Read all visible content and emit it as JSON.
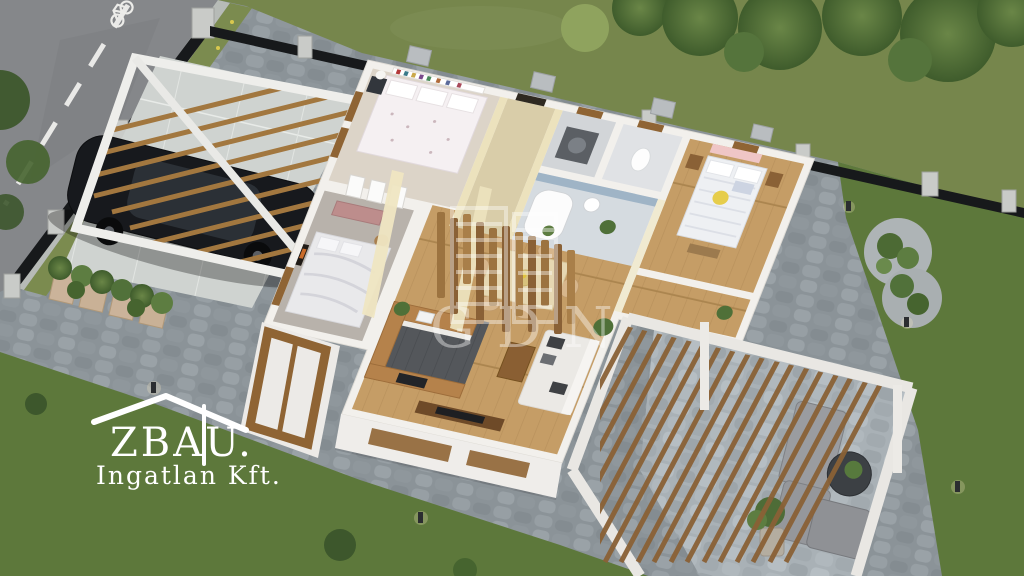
{
  "watermark": {
    "text": "GDN"
  },
  "logo": {
    "title": "ZBAU.",
    "subtitle": "Ingatlan Kft."
  },
  "palette": {
    "grass_top": "#76864c",
    "grass_side": "#5d783b",
    "road": "#85878a",
    "curb": "#b7bbb7",
    "roadside_grass": "#7b8b4f",
    "wall_white": "#f2f0ec",
    "wood_floor": "#c59d66",
    "wood_accent": "#8f6434",
    "carpet_gray": "#b8b2ab",
    "carpet_beige": "#dcd4c8",
    "kitchen_floor": "#54575b",
    "fence_dark": "#17191b",
    "car_black": "#17191d",
    "pink_accent": "#efc6c6",
    "pergola_wood": "#8a6136",
    "watermark_white": "#ffffff"
  }
}
